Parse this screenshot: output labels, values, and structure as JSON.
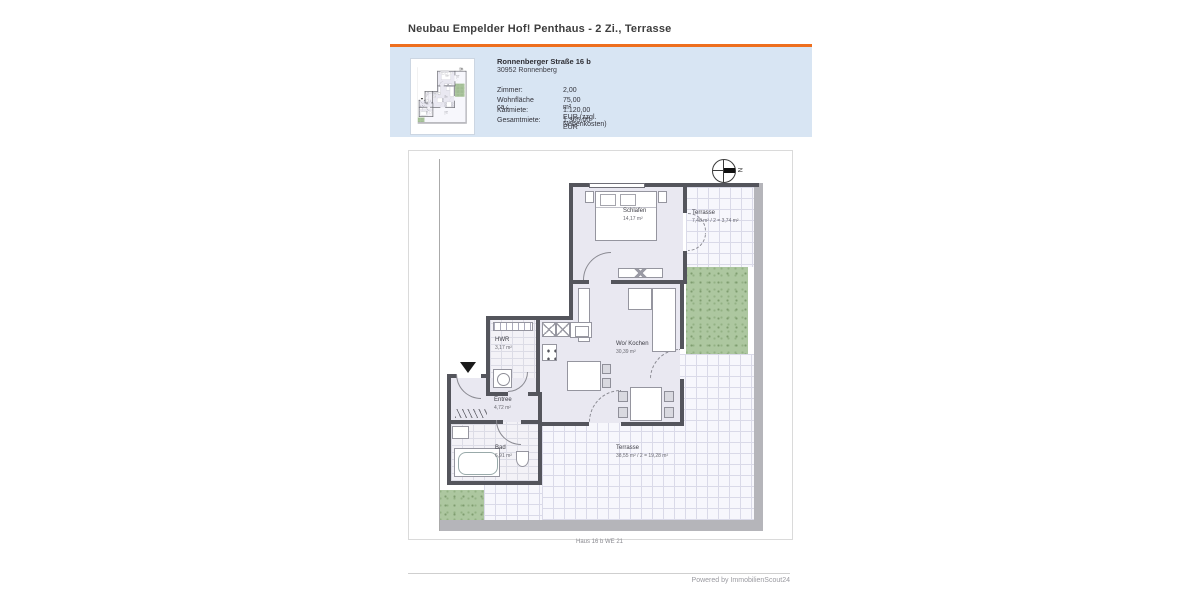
{
  "page": {
    "title": "Neubau Empelder Hof! Penthaus - 2 Zi., Terrasse"
  },
  "colors": {
    "accent_orange": "#ee6f1e",
    "info_box_blue": "#d8e5f3",
    "wall_gray": "#54555c",
    "floor_lavender": "#e9e8f1",
    "garden_green": "#adc7a0"
  },
  "info_box": {
    "address_line1": "Ronnenberger Straße 16 b",
    "address_line2": "30952 Ronnenberg",
    "rows": [
      {
        "label": "Zimmer:",
        "value": "2,00"
      },
      {
        "label": "Wohnfläche ca.:",
        "value": "75,00 m²"
      },
      {
        "label": "Kaltmiete:",
        "value": "1.120,00 EUR (zzgl. Nebenkosten)"
      },
      {
        "label": "Gesamtmiete:",
        "value": "1.365,00 EUR"
      }
    ]
  },
  "floorplan": {
    "caption": "Haus 16 b WE 21",
    "compass_label": "N",
    "rooms": [
      {
        "name": "Schlafen",
        "area": "14,17 m²"
      },
      {
        "name": "Terrasse",
        "area": "7,48 m² / 2 = 3,74 m²"
      },
      {
        "name": "HWR",
        "area": "3,17 m²"
      },
      {
        "name": "Wo/ Kochen",
        "area": "30,39 m²"
      },
      {
        "name": "Entree",
        "area": "4,72 m²"
      },
      {
        "name": "Bad",
        "area": "6,91 m²"
      },
      {
        "name": "Terrasse",
        "area": "38,55 m² / 2 = 19,28 m²"
      }
    ]
  },
  "footer": {
    "text": "Powered by ImmobilienScout24"
  }
}
